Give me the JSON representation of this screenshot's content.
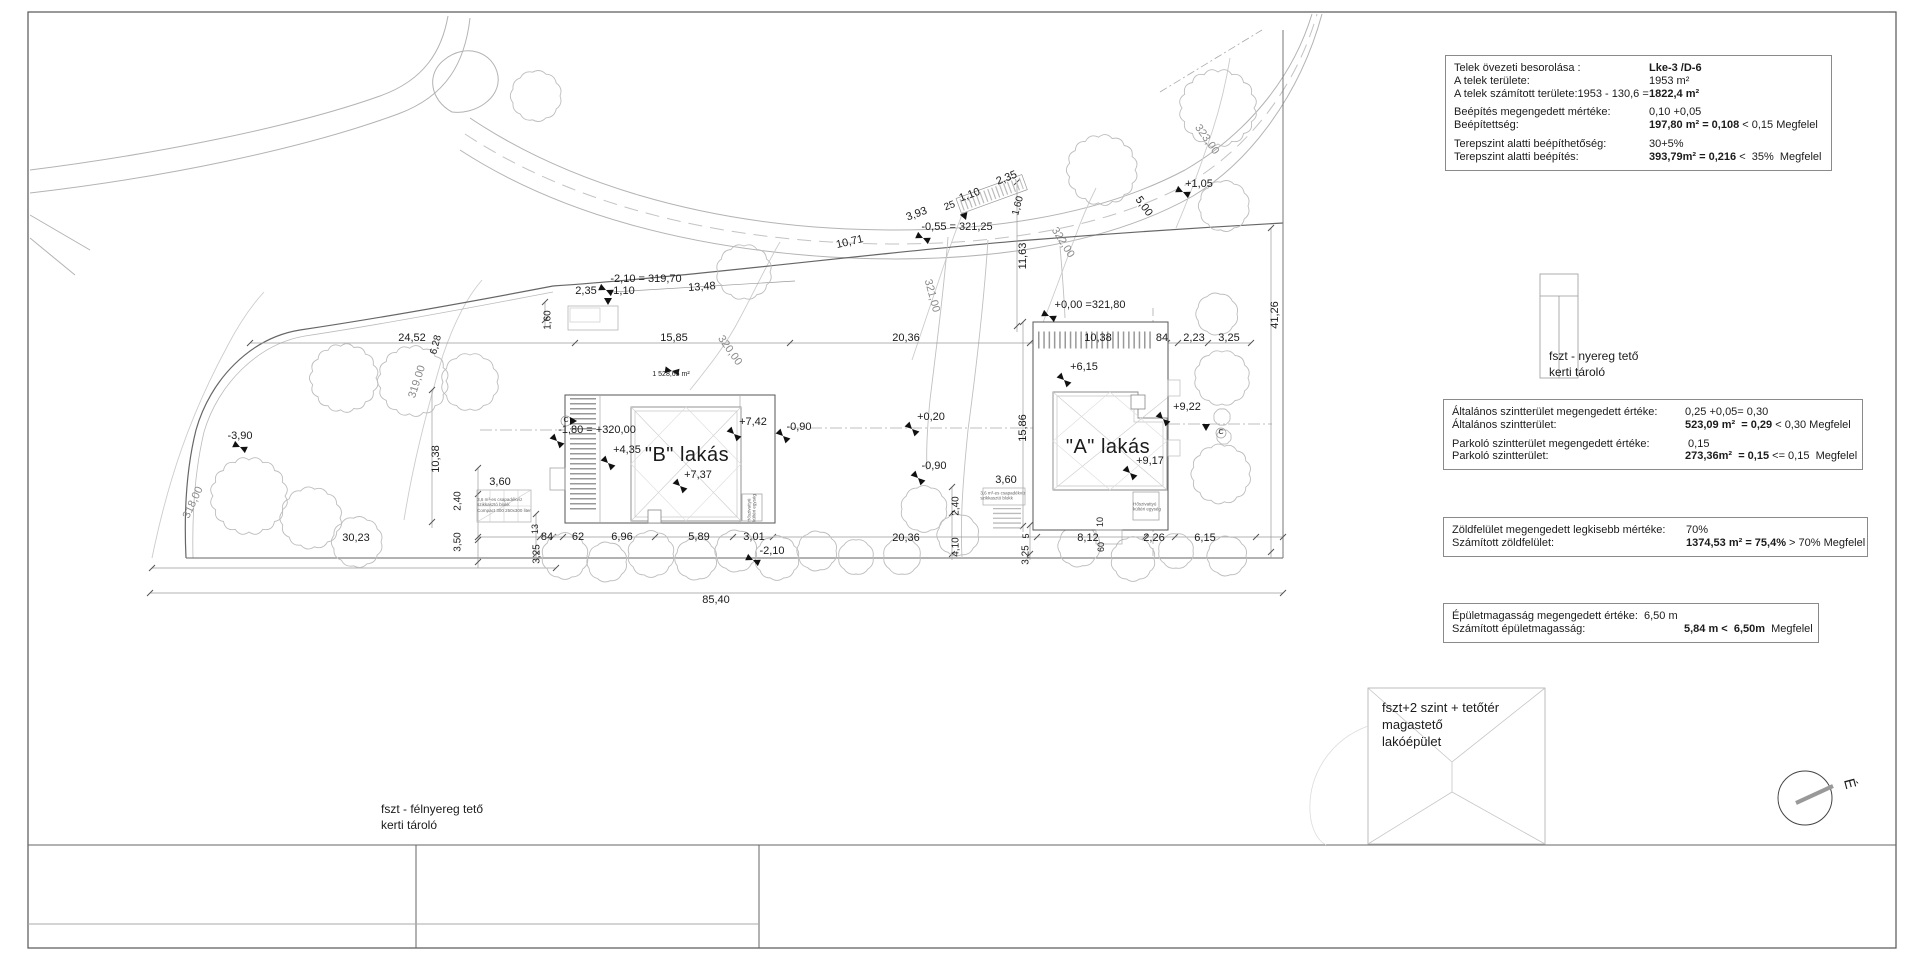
{
  "info_boxes": {
    "zoning": {
      "lw": 195,
      "rows": [
        {
          "l": "Telek övezeti besorolása :",
          "b": "Lke-3 /D-6"
        },
        {
          "l": "A telek területe:",
          "v": "1953 m²"
        },
        {
          "l": "A telek számított területe:1953 - 130,6 = ",
          "b": "1822,4 m²"
        },
        {
          "sp": true
        },
        {
          "l": "Beépítés megengedett mértéke:",
          "v": "0,10 +0,05"
        },
        {
          "l": "Beépítettség:",
          "b": "197,80 m² = 0,108",
          "r": " < 0,15 Megfelel"
        },
        {
          "sp": true
        },
        {
          "l": "Terepszint alatti beépíthetőség:",
          "v": "30+5%"
        },
        {
          "l": "Terepszint alatti beépítés:",
          "b": "393,79m² = 0,216",
          "r": " <  35%  Megfelel"
        }
      ]
    },
    "floor_area": {
      "lw": 233,
      "rows": [
        {
          "l": "Általános szintterület megengedett értéke:",
          "v": "0,25 +0,05= 0,30"
        },
        {
          "l": "Általános szintterület:",
          "b": "523,09 m²  = 0,29",
          "r": " < 0,30 Megfelel"
        },
        {
          "sp": true
        },
        {
          "l": "Parkoló szintterület megengedett értéke:",
          "v": " 0,15"
        },
        {
          "l": "Parkoló szintterület:",
          "b": "273,36m²  = 0,15",
          "r": " <= 0,15  Megfelel"
        }
      ]
    },
    "green": {
      "lw": 234,
      "rows": [
        {
          "l": "Zöldfelület megengedett legkisebb mértéke:",
          "v": "70%"
        },
        {
          "l": "Számított zöldfelület:",
          "b": "1374,53 m² = 75,4%",
          "r": " > 70% Megfelel"
        }
      ]
    },
    "height": {
      "lw": 192,
      "rows": [
        {
          "l": "Épületmagasság megengedett értéke:",
          "v": "6,50 m",
          "w": 192
        },
        {
          "l": "Számított épületmagasság:",
          "b": "5,84 m <  6,50m",
          "r": "  Megfelel",
          "w": 232
        }
      ]
    }
  },
  "annotations": [
    {
      "t": "10,71",
      "x": 850,
      "y": 243,
      "r": -13
    },
    {
      "t": "3,93",
      "x": 917,
      "y": 215,
      "r": -20
    },
    {
      "t": "25",
      "x": 950,
      "y": 207,
      "r": -20,
      "s": 10
    },
    {
      "t": "1,10",
      "x": 970,
      "y": 196,
      "r": -20
    },
    {
      "t": "2,35",
      "x": 1007,
      "y": 179,
      "r": -22
    },
    {
      "t": "-0,55 = 321,25",
      "x": 957,
      "y": 228,
      "c": "lvl"
    },
    {
      "t": "1,60",
      "x": 1019,
      "y": 206,
      "r": -75,
      "s": 10
    },
    {
      "t": "11,63",
      "x": 1024,
      "y": 256,
      "r": -90
    },
    {
      "t": "322,00",
      "x": 1062,
      "y": 243,
      "r": 58,
      "c": "contour"
    },
    {
      "t": "5,00",
      "x": 1143,
      "y": 207,
      "r": 55
    },
    {
      "t": "+1,05",
      "x": 1199,
      "y": 185,
      "c": "lvl"
    },
    {
      "t": "323,00",
      "x": 1206,
      "y": 140,
      "r": 55,
      "c": "contour"
    },
    {
      "t": "321,00",
      "x": 931,
      "y": 296,
      "r": 75,
      "c": "contour"
    },
    {
      "t": "-2,10 = 319,70",
      "x": 646,
      "y": 280,
      "c": "lvl"
    },
    {
      "t": "2,35",
      "x": 586,
      "y": 292
    },
    {
      "t": "1,10",
      "x": 624,
      "y": 292
    },
    {
      "t": "13,48",
      "x": 702,
      "y": 288,
      "r": -4
    },
    {
      "t": "1,60",
      "x": 549,
      "y": 320,
      "r": -90,
      "s": 10
    },
    {
      "t": "15,85",
      "x": 674,
      "y": 339
    },
    {
      "t": "320,00",
      "x": 729,
      "y": 351,
      "r": 55,
      "c": "contour"
    },
    {
      "t": "1 528,65 m²",
      "x": 671,
      "y": 375,
      "s": 7
    },
    {
      "t": "24,52",
      "x": 412,
      "y": 339
    },
    {
      "t": "-3,90",
      "x": 240,
      "y": 437,
      "c": "lvl"
    },
    {
      "t": "318,00",
      "x": 194,
      "y": 503,
      "r": -65,
      "c": "contour"
    },
    {
      "t": "30,23",
      "x": 356,
      "y": 539
    },
    {
      "t": "6,28",
      "x": 437,
      "y": 345,
      "r": -75,
      "s": 10
    },
    {
      "t": "319,00",
      "x": 418,
      "y": 382,
      "r": -72,
      "c": "contour"
    },
    {
      "t": "10,38",
      "x": 437,
      "y": 459,
      "r": -90
    },
    {
      "t": "2,40",
      "x": 459,
      "y": 501,
      "r": -90,
      "s": 10
    },
    {
      "t": "3,50",
      "x": 459,
      "y": 542,
      "r": -90,
      "s": 10
    },
    {
      "t": "13",
      "x": 536,
      "y": 529,
      "r": -90,
      "s": 9
    },
    {
      "t": "3,25",
      "x": 538,
      "y": 554,
      "r": -90,
      "s": 10
    },
    {
      "t": "84",
      "x": 547,
      "y": 538
    },
    {
      "t": "62",
      "x": 578,
      "y": 538
    },
    {
      "t": "6,96",
      "x": 622,
      "y": 538
    },
    {
      "t": "5,89",
      "x": 699,
      "y": 538
    },
    {
      "t": "3,01",
      "x": 754,
      "y": 538
    },
    {
      "t": "-2,10",
      "x": 772,
      "y": 552,
      "c": "lvl"
    },
    {
      "t": "85,40",
      "x": 716,
      "y": 601
    },
    {
      "t": "-1,80 = +320,00",
      "x": 597,
      "y": 431,
      "c": "lvl"
    },
    {
      "t": "+4,35",
      "x": 627,
      "y": 451,
      "c": "lvl"
    },
    {
      "t": "\"B\" lakás",
      "x": 687,
      "y": 456,
      "c": "big"
    },
    {
      "t": "+7,37",
      "x": 698,
      "y": 476,
      "c": "lvl"
    },
    {
      "t": "+7,42",
      "x": 753,
      "y": 423,
      "c": "lvl"
    },
    {
      "t": "-0,90",
      "x": 799,
      "y": 428,
      "c": "lvl"
    },
    {
      "t": "3,60",
      "x": 500,
      "y": 483
    },
    {
      "t": "3,6 m³-es csapadékvíz\nszikkasztó blokk\nCompact 300 250x300 liter",
      "x": 504,
      "y": 505,
      "s": 4.5,
      "c": "tiny"
    },
    {
      "t": "Hőszivattyú\nkültéri egység",
      "x": 752,
      "y": 508,
      "r": -90,
      "s": 4.5,
      "c": "tiny"
    },
    {
      "t": "C",
      "x": 566,
      "y": 421,
      "s": 7
    },
    {
      "t": "+0,20",
      "x": 931,
      "y": 418,
      "c": "lvl"
    },
    {
      "t": "20,36",
      "x": 906,
      "y": 339
    },
    {
      "t": "20,36",
      "x": 906,
      "y": 539
    },
    {
      "t": "-0,90",
      "x": 934,
      "y": 467,
      "c": "lvl"
    },
    {
      "t": "3,60",
      "x": 1006,
      "y": 481
    },
    {
      "t": "3,6 m³-es csapadékvíz\nszikkasztó blokk",
      "x": 1003,
      "y": 496,
      "s": 4.5,
      "c": "tiny"
    },
    {
      "t": "2,40",
      "x": 957,
      "y": 506,
      "r": -90,
      "s": 10
    },
    {
      "t": "4,10",
      "x": 957,
      "y": 547,
      "r": -90,
      "s": 10
    },
    {
      "t": "5",
      "x": 1027,
      "y": 536,
      "r": -90,
      "s": 9
    },
    {
      "t": "3,25",
      "x": 1027,
      "y": 555,
      "r": -90,
      "s": 10
    },
    {
      "t": "8,12",
      "x": 1088,
      "y": 539
    },
    {
      "t": "10",
      "x": 1101,
      "y": 522,
      "r": -90,
      "s": 9
    },
    {
      "t": "60",
      "x": 1102,
      "y": 547,
      "r": -90,
      "s": 9
    },
    {
      "t": "2,26",
      "x": 1154,
      "y": 539
    },
    {
      "t": "6,15",
      "x": 1205,
      "y": 539
    },
    {
      "t": "15,86",
      "x": 1024,
      "y": 428,
      "r": -90
    },
    {
      "t": "\"A\" lakás",
      "x": 1108,
      "y": 448,
      "c": "big"
    },
    {
      "t": "+9,17",
      "x": 1150,
      "y": 462,
      "c": "lvl"
    },
    {
      "t": "+9,22",
      "x": 1187,
      "y": 408,
      "c": "lvl"
    },
    {
      "t": "+6,15",
      "x": 1084,
      "y": 368,
      "c": "lvl"
    },
    {
      "t": "10,38",
      "x": 1098,
      "y": 339
    },
    {
      "t": "84",
      "x": 1162,
      "y": 339
    },
    {
      "t": "2,23",
      "x": 1194,
      "y": 339
    },
    {
      "t": "3,25",
      "x": 1229,
      "y": 339
    },
    {
      "t": "+0,00 =321,80",
      "x": 1090,
      "y": 306,
      "c": "lvl"
    },
    {
      "t": "41,26",
      "x": 1276,
      "y": 315,
      "r": -90
    },
    {
      "t": "Hőszivattyú\nkültéri egység",
      "x": 1147,
      "y": 507,
      "s": 4.5,
      "c": "tiny"
    },
    {
      "t": "C",
      "x": 1221,
      "y": 433,
      "s": 7
    },
    {
      "t": "fszt - nyereg tető\nkerti tároló",
      "x": 1549,
      "y": 349,
      "c": "note"
    },
    {
      "t": "fszt+2 szint + tetőtér\nmagastető\nlakóépület",
      "x": 1382,
      "y": 700,
      "c": "note",
      "s": 13
    },
    {
      "t": "fszt - félnyereg tető\nkerti tároló",
      "x": 381,
      "y": 802,
      "c": "note"
    },
    {
      "t": "É",
      "x": 1849,
      "y": 784,
      "r": 75,
      "s": 15,
      "c": "north"
    }
  ],
  "trees": [
    {
      "x": 536,
      "y": 96,
      "r": 24
    },
    {
      "x": 744,
      "y": 272,
      "r": 26
    },
    {
      "x": 1102,
      "y": 170,
      "r": 33
    },
    {
      "x": 1218,
      "y": 108,
      "r": 36
    },
    {
      "x": 1224,
      "y": 206,
      "r": 24
    },
    {
      "x": 1217,
      "y": 314,
      "r": 20
    },
    {
      "x": 1222,
      "y": 378,
      "r": 26
    },
    {
      "x": 1221,
      "y": 474,
      "r": 28
    },
    {
      "x": 1222,
      "y": 417,
      "r": 8
    },
    {
      "x": 1224,
      "y": 437,
      "r": 7
    },
    {
      "x": 344,
      "y": 378,
      "r": 32
    },
    {
      "x": 413,
      "y": 381,
      "r": 33
    },
    {
      "x": 470,
      "y": 382,
      "r": 27
    },
    {
      "x": 249,
      "y": 496,
      "r": 36
    },
    {
      "x": 311,
      "y": 518,
      "r": 29
    },
    {
      "x": 357,
      "y": 542,
      "r": 24
    },
    {
      "x": 565,
      "y": 556,
      "r": 22
    },
    {
      "x": 607,
      "y": 562,
      "r": 19
    },
    {
      "x": 651,
      "y": 554,
      "r": 22
    },
    {
      "x": 696,
      "y": 559,
      "r": 20
    },
    {
      "x": 736,
      "y": 551,
      "r": 20
    },
    {
      "x": 777,
      "y": 558,
      "r": 21
    },
    {
      "x": 817,
      "y": 551,
      "r": 19
    },
    {
      "x": 856,
      "y": 557,
      "r": 17
    },
    {
      "x": 924,
      "y": 509,
      "r": 22
    },
    {
      "x": 958,
      "y": 535,
      "r": 20
    },
    {
      "x": 902,
      "y": 556,
      "r": 18
    },
    {
      "x": 1079,
      "y": 546,
      "r": 20
    },
    {
      "x": 1133,
      "y": 559,
      "r": 21
    },
    {
      "x": 1176,
      "y": 551,
      "r": 17
    },
    {
      "x": 1227,
      "y": 556,
      "r": 19
    }
  ],
  "markers": [
    {
      "x": 240,
      "y": 447,
      "r": 25,
      "k": "bt"
    },
    {
      "x": 606,
      "y": 290,
      "r": 25,
      "k": "bt"
    },
    {
      "x": 923,
      "y": 238,
      "r": 25,
      "k": "bt"
    },
    {
      "x": 1049,
      "y": 316,
      "r": 25,
      "k": "bt"
    },
    {
      "x": 1183,
      "y": 192,
      "r": 25,
      "k": "bt"
    },
    {
      "x": 557,
      "y": 441,
      "r": 45,
      "k": "bt"
    },
    {
      "x": 608,
      "y": 463,
      "r": 45,
      "k": "bt"
    },
    {
      "x": 680,
      "y": 486,
      "r": 45,
      "k": "bt"
    },
    {
      "x": 734,
      "y": 434,
      "r": 45,
      "k": "bt"
    },
    {
      "x": 783,
      "y": 436,
      "r": 45,
      "k": "bt"
    },
    {
      "x": 912,
      "y": 429,
      "r": 45,
      "k": "bt"
    },
    {
      "x": 918,
      "y": 478,
      "r": 45,
      "k": "bt"
    },
    {
      "x": 1064,
      "y": 380,
      "r": 45,
      "k": "bt"
    },
    {
      "x": 1130,
      "y": 473,
      "r": 45,
      "k": "bt"
    },
    {
      "x": 1163,
      "y": 419,
      "r": 45,
      "k": "bt"
    },
    {
      "x": 753,
      "y": 560,
      "r": 25,
      "k": "bt"
    },
    {
      "x": 672,
      "y": 371,
      "r": 10,
      "k": "bt"
    },
    {
      "x": 608,
      "y": 305,
      "r": 0,
      "k": "tr"
    },
    {
      "x": 966,
      "y": 220,
      "r": -20,
      "k": "tr"
    },
    {
      "x": 1206,
      "y": 431,
      "r": 0,
      "k": "tr"
    },
    {
      "x": 577,
      "y": 421,
      "r": -90,
      "k": "tr"
    }
  ]
}
